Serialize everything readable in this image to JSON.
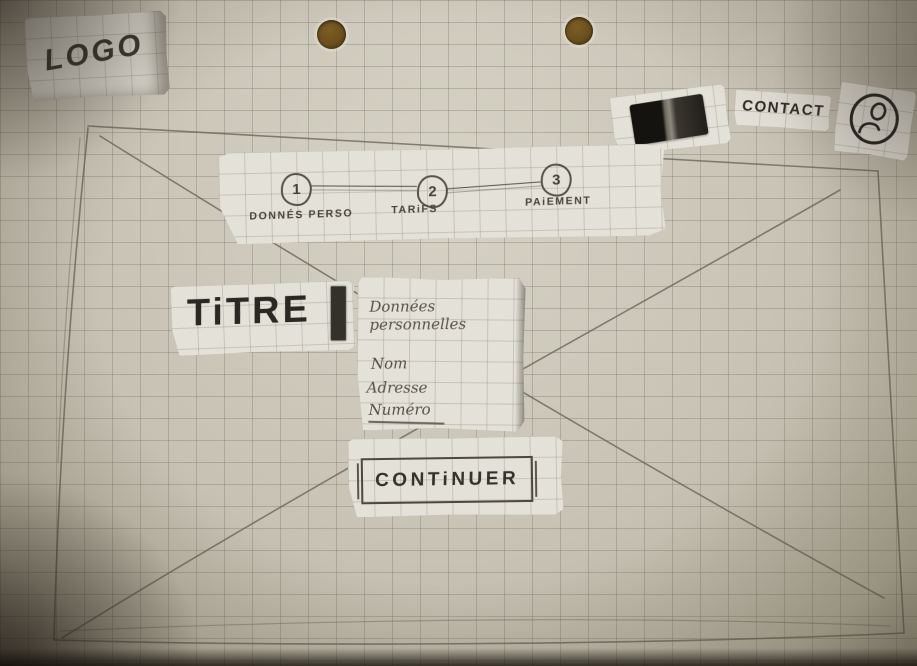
{
  "header": {
    "logo_label": "LOGO",
    "cart_icon": "cart",
    "contact_label": "CONTACT",
    "account_icon": "user-circle"
  },
  "stepper": {
    "steps": [
      {
        "number": "1",
        "label": "DONNÉS PERSO"
      },
      {
        "number": "2",
        "label": "TARiFS"
      },
      {
        "number": "3",
        "label": "PAiEMENT"
      }
    ]
  },
  "main": {
    "title": "TiTRE",
    "form": {
      "heading": "Données personnelles",
      "fields": [
        {
          "label": "Nom"
        },
        {
          "label": "Adresse"
        },
        {
          "label": "Numéro"
        }
      ]
    },
    "continue_label": "CONTiNUER"
  },
  "colors": {
    "paper": "#c7c2b4",
    "scrap": "#e4e1d8",
    "pencil": "#56524a",
    "marker": "#26231f",
    "hole": "#7c5e24"
  }
}
